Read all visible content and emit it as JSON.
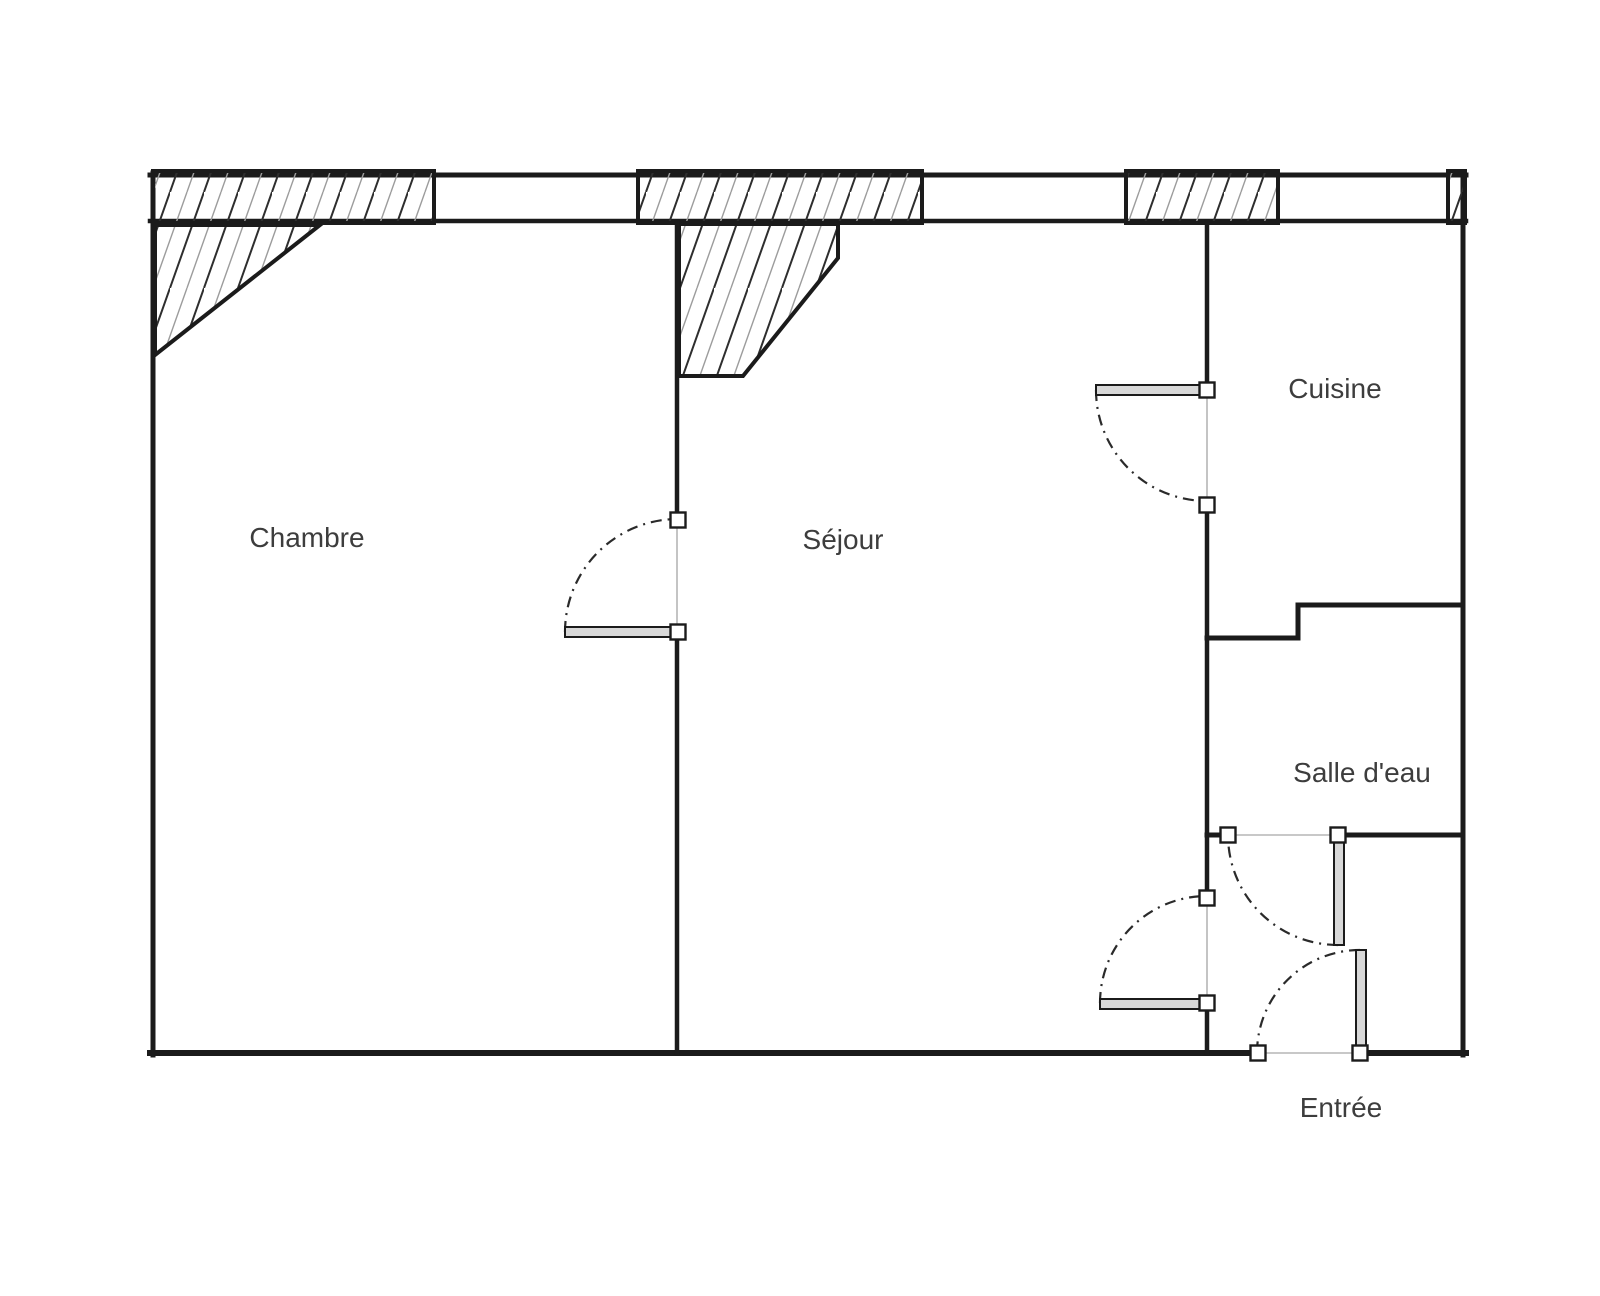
{
  "plan": {
    "type": "apartment-floor-plan",
    "rooms": {
      "chambre": "Chambre",
      "sejour": "Séjour",
      "cuisine": "Cuisine",
      "salle_deau": "Salle d'eau",
      "entree": "Entrée"
    },
    "colors": {
      "background": "#ffffff",
      "wall": "#1b1b1b",
      "hatch_dark": "#2e2e2e",
      "hatch_light": "#9c9c9c",
      "door_swing": "#2a2a2a",
      "door_leaf_fill": "#d8d8d8",
      "opening_line": "#b5b5b5",
      "text": "#3d3d3d"
    }
  }
}
